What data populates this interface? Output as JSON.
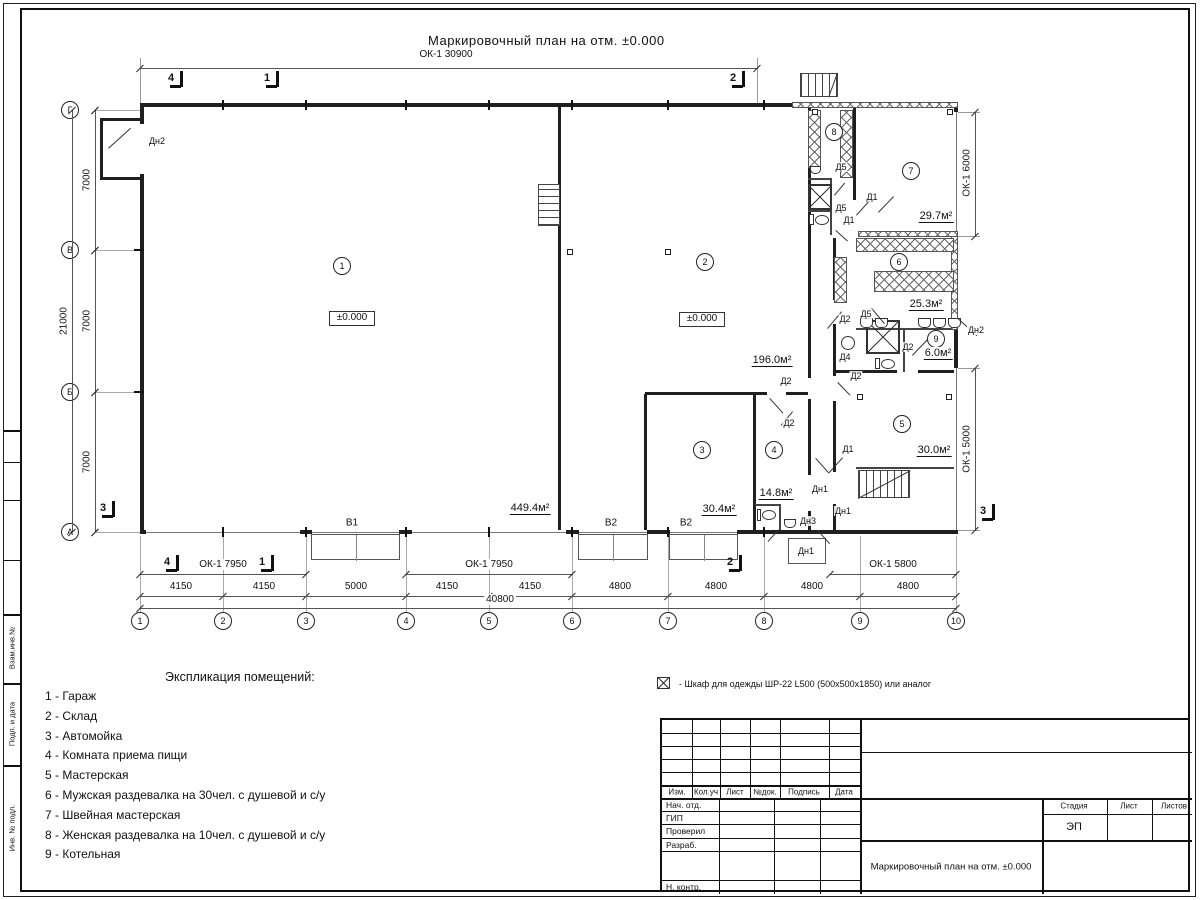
{
  "sheet": {
    "title": "Маркировочный план на отм. ±0.000",
    "top_window_dim": "ОК-1 30900"
  },
  "plan": {
    "room_numbers": [
      {
        "n": "1",
        "x": 342,
        "y": 266
      },
      {
        "n": "2",
        "x": 705,
        "y": 262
      },
      {
        "n": "3",
        "x": 702,
        "y": 450
      },
      {
        "n": "4",
        "x": 774,
        "y": 450
      },
      {
        "n": "5",
        "x": 902,
        "y": 424
      },
      {
        "n": "6",
        "x": 899,
        "y": 262
      },
      {
        "n": "7",
        "x": 911,
        "y": 171
      },
      {
        "n": "8",
        "x": 834,
        "y": 132
      },
      {
        "n": "9",
        "x": 936,
        "y": 339
      }
    ],
    "area_labels": [
      {
        "text": "449.4м²",
        "x": 530,
        "y": 509
      },
      {
        "text": "196.0м²",
        "x": 772,
        "y": 361
      },
      {
        "text": "30.4м²",
        "x": 719,
        "y": 510
      },
      {
        "text": "14.8м²",
        "x": 776,
        "y": 494
      },
      {
        "text": "30.0м²",
        "x": 934,
        "y": 451
      },
      {
        "text": "25.3м²",
        "x": 926,
        "y": 305
      },
      {
        "text": "6.0м²",
        "x": 938,
        "y": 354
      },
      {
        "text": "29.7м²",
        "x": 936,
        "y": 217
      }
    ],
    "level_marks": [
      {
        "text": "±0.000",
        "x": 352,
        "y": 319
      },
      {
        "text": "±0.000",
        "x": 702,
        "y": 320
      }
    ],
    "door_labels": [
      {
        "text": "Дн2",
        "x": 157,
        "y": 141
      },
      {
        "text": "Д5",
        "x": 841,
        "y": 167
      },
      {
        "text": "Д1",
        "x": 872,
        "y": 197
      },
      {
        "text": "Д5",
        "x": 841,
        "y": 208
      },
      {
        "text": "Д1",
        "x": 849,
        "y": 220
      },
      {
        "text": "Д2",
        "x": 845,
        "y": 319
      },
      {
        "text": "Д5",
        "x": 866,
        "y": 314
      },
      {
        "text": "Д2",
        "x": 908,
        "y": 347
      },
      {
        "text": "Д4",
        "x": 845,
        "y": 357
      },
      {
        "text": "Д2",
        "x": 856,
        "y": 376
      },
      {
        "text": "Дн2",
        "x": 976,
        "y": 330
      },
      {
        "text": "Д2",
        "x": 786,
        "y": 381
      },
      {
        "text": "Д2",
        "x": 789,
        "y": 423
      },
      {
        "text": "Д1",
        "x": 848,
        "y": 449
      },
      {
        "text": "Дн1",
        "x": 820,
        "y": 489
      },
      {
        "text": "Дн1",
        "x": 843,
        "y": 511
      },
      {
        "text": "Дн3",
        "x": 808,
        "y": 521
      },
      {
        "text": "Дн1",
        "x": 806,
        "y": 551
      }
    ],
    "gate_labels": [
      {
        "text": "В1",
        "x": 352,
        "y": 523
      },
      {
        "text": "В2",
        "x": 611,
        "y": 523
      },
      {
        "text": "В2",
        "x": 686,
        "y": 523
      }
    ],
    "section_marks": [
      {
        "label": "4",
        "x": 172,
        "y": 80
      },
      {
        "label": "1",
        "x": 268,
        "y": 80
      },
      {
        "label": "2",
        "x": 734,
        "y": 80
      },
      {
        "label": "4",
        "x": 168,
        "y": 564
      },
      {
        "label": "1",
        "x": 263,
        "y": 564
      },
      {
        "label": "2",
        "x": 731,
        "y": 564
      },
      {
        "label": "3",
        "x": 104,
        "y": 510
      },
      {
        "label": "3",
        "x": 984,
        "y": 513
      }
    ],
    "axes_cols": [
      {
        "label": "1",
        "x": 140
      },
      {
        "label": "2",
        "x": 223
      },
      {
        "label": "3",
        "x": 306
      },
      {
        "label": "4",
        "x": 406
      },
      {
        "label": "5",
        "x": 489
      },
      {
        "label": "6",
        "x": 572
      },
      {
        "label": "7",
        "x": 668
      },
      {
        "label": "8",
        "x": 764
      },
      {
        "label": "9",
        "x": 860
      },
      {
        "label": "10",
        "x": 956
      }
    ],
    "axes_rows": [
      {
        "label": "Г",
        "y": 110
      },
      {
        "label": "В",
        "y": 250
      },
      {
        "label": "Б",
        "y": 392
      },
      {
        "label": "А",
        "y": 532
      }
    ],
    "dims": {
      "top": {
        "text": "ОК-1 30900",
        "x": 446,
        "y": 55
      },
      "windows_bottom": [
        {
          "text": "ОК-1 7950",
          "x": 223,
          "y": 565
        },
        {
          "text": "ОК-1 7950",
          "x": 489,
          "y": 565
        },
        {
          "text": "ОК-1 5800",
          "x": 893,
          "y": 565
        }
      ],
      "segments_bottom": [
        {
          "text": "4150",
          "x": 181,
          "y": 587
        },
        {
          "text": "4150",
          "x": 264,
          "y": 587
        },
        {
          "text": "5000",
          "x": 356,
          "y": 587
        },
        {
          "text": "4150",
          "x": 447,
          "y": 587
        },
        {
          "text": "4150",
          "x": 530,
          "y": 587
        },
        {
          "text": "4800",
          "x": 620,
          "y": 587
        },
        {
          "text": "4800",
          "x": 716,
          "y": 587
        },
        {
          "text": "4800",
          "x": 812,
          "y": 587
        },
        {
          "text": "4800",
          "x": 908,
          "y": 587
        }
      ],
      "total_bottom": {
        "text": "40800",
        "x": 500,
        "y": 600
      },
      "left_segments": [
        {
          "text": "7000",
          "x": 87,
          "y": 180
        },
        {
          "text": "7000",
          "x": 87,
          "y": 321
        },
        {
          "text": "7000",
          "x": 87,
          "y": 462
        }
      ],
      "left_total": {
        "text": "21000",
        "x": 64,
        "y": 321
      },
      "right": [
        {
          "text": "ОК-1 6000",
          "x": 967,
          "y": 173
        },
        {
          "text": "ОК-1 5000",
          "x": 967,
          "y": 449
        }
      ]
    }
  },
  "legend": {
    "title": "Экспликация помещений:",
    "items": [
      "1 - Гараж",
      "2 - Склад",
      "3 - Автомойка",
      "4 - Комната приема пищи",
      "5 - Мастерская",
      "6 - Мужская раздевалка на 30чел. с душевой и с/у",
      "7 - Швейная мастерская",
      "8 - Женская раздевалка на 10чел. с душевой и с/у",
      "9 - Котельная"
    ]
  },
  "note": {
    "text": "- Шкаф для одежды ШР-22 L500 (500x500x1850) или аналог"
  },
  "titleblock": {
    "header_cols": [
      "Изм.",
      "Кол.уч",
      "Лист",
      "№док.",
      "Подпись",
      "Дата"
    ],
    "roles": [
      "Нач. отд.",
      "ГИП",
      "Проверил",
      "Разраб.",
      "Н. контр."
    ],
    "stage_label": "Стадия",
    "sheet_label": "Лист",
    "sheets_label": "Листов",
    "stage_value": "ЭП",
    "doc_title": "Маркировочный план на отм. ±0.000"
  },
  "side_stamp": [
    "Взам.инв.№",
    "Подп. и дата",
    "Инв. № подл."
  ]
}
